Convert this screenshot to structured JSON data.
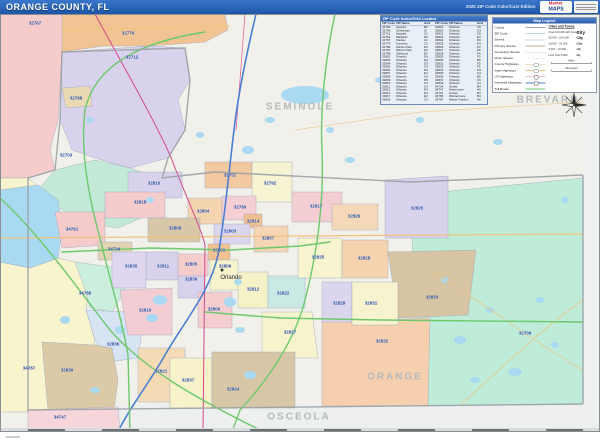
{
  "header": {
    "title": "ORANGE COUNTY, FL",
    "edition": "2020 ZIP Code Color/Cast Edition",
    "logo_line1": "Market",
    "logo_line2": "MAPS"
  },
  "map": {
    "city_label": "Orlando",
    "county_labels": [
      {
        "text": "SEMINOLE",
        "x": 300,
        "y": 107
      },
      {
        "text": "BREVARD",
        "x": 548,
        "y": 100
      },
      {
        "text": "ORANGE",
        "x": 395,
        "y": 377
      },
      {
        "text": "OSCEOLA",
        "x": 299,
        "y": 417
      }
    ],
    "zip_labels": [
      {
        "text": "32767",
        "x": 35,
        "y": 23
      },
      {
        "text": "32776",
        "x": 128,
        "y": 33
      },
      {
        "text": "32712",
        "x": 132,
        "y": 57
      },
      {
        "text": "32798",
        "x": 76,
        "y": 98
      },
      {
        "text": "32703",
        "x": 66,
        "y": 155
      },
      {
        "text": "32810",
        "x": 154,
        "y": 183
      },
      {
        "text": "32751",
        "x": 230,
        "y": 175
      },
      {
        "text": "32792",
        "x": 270,
        "y": 183
      },
      {
        "text": "32818",
        "x": 140,
        "y": 202
      },
      {
        "text": "32804",
        "x": 203,
        "y": 211
      },
      {
        "text": "32789",
        "x": 240,
        "y": 207
      },
      {
        "text": "32817",
        "x": 316,
        "y": 206
      },
      {
        "text": "32820",
        "x": 417,
        "y": 208
      },
      {
        "text": "34761",
        "x": 72,
        "y": 229
      },
      {
        "text": "32808",
        "x": 175,
        "y": 228
      },
      {
        "text": "32814",
        "x": 253,
        "y": 221
      },
      {
        "text": "32803",
        "x": 230,
        "y": 231
      },
      {
        "text": "32807",
        "x": 268,
        "y": 238
      },
      {
        "text": "34734",
        "x": 114,
        "y": 249
      },
      {
        "text": "32801",
        "x": 219,
        "y": 250
      },
      {
        "text": "32825",
        "x": 318,
        "y": 257
      },
      {
        "text": "32826",
        "x": 354,
        "y": 216
      },
      {
        "text": "32828",
        "x": 364,
        "y": 258
      },
      {
        "text": "32811",
        "x": 163,
        "y": 266
      },
      {
        "text": "32805",
        "x": 191,
        "y": 264
      },
      {
        "text": "32806",
        "x": 225,
        "y": 266
      },
      {
        "text": "32835",
        "x": 131,
        "y": 266
      },
      {
        "text": "32839",
        "x": 191,
        "y": 279
      },
      {
        "text": "32812",
        "x": 253,
        "y": 289
      },
      {
        "text": "32822",
        "x": 283,
        "y": 293
      },
      {
        "text": "34786",
        "x": 85,
        "y": 293
      },
      {
        "text": "32819",
        "x": 145,
        "y": 310
      },
      {
        "text": "32809",
        "x": 214,
        "y": 309
      },
      {
        "text": "32829",
        "x": 339,
        "y": 303
      },
      {
        "text": "32831",
        "x": 371,
        "y": 303
      },
      {
        "text": "32833",
        "x": 432,
        "y": 297
      },
      {
        "text": "32827",
        "x": 290,
        "y": 332
      },
      {
        "text": "32709",
        "x": 525,
        "y": 333
      },
      {
        "text": "32836",
        "x": 113,
        "y": 344
      },
      {
        "text": "32832",
        "x": 382,
        "y": 341
      },
      {
        "text": "32830",
        "x": 67,
        "y": 370
      },
      {
        "text": "32821",
        "x": 161,
        "y": 371
      },
      {
        "text": "32837",
        "x": 188,
        "y": 380
      },
      {
        "text": "32824",
        "x": 233,
        "y": 389
      },
      {
        "text": "34787",
        "x": 29,
        "y": 368
      },
      {
        "text": "34747",
        "x": 60,
        "y": 417
      }
    ]
  },
  "index_table": {
    "title": "ZIP Code Index/Grid Locator",
    "columns": [
      "ZIP Code",
      "ZIP Name",
      "Grid"
    ],
    "rows": [
      [
        "32703",
        "Apopka",
        "B3"
      ],
      [
        "32709",
        "Christmas",
        "I5"
      ],
      [
        "32712",
        "Apopka",
        "C1"
      ],
      [
        "32751",
        "Maitland",
        "D3"
      ],
      [
        "32767",
        "Paisley",
        "A1"
      ],
      [
        "32776",
        "Sorrento",
        "C1"
      ],
      [
        "32789",
        "Winter Park",
        "D3"
      ],
      [
        "32792",
        "Winter Park",
        "E3"
      ],
      [
        "32798",
        "Zellwood",
        "B2"
      ],
      [
        "32801",
        "Orlando",
        "D4"
      ],
      [
        "32803",
        "Orlando",
        "D4"
      ],
      [
        "32804",
        "Orlando",
        "D3"
      ],
      [
        "32805",
        "Orlando",
        "C4"
      ],
      [
        "32806",
        "Orlando",
        "D4"
      ],
      [
        "32807",
        "Orlando",
        "E4"
      ],
      [
        "32808",
        "Orlando",
        "C4"
      ],
      [
        "32809",
        "Orlando",
        "D5"
      ],
      [
        "32810",
        "Orlando",
        "C3"
      ],
      [
        "32811",
        "Orlando",
        "C4"
      ],
      [
        "32812",
        "Orlando",
        "E4"
      ],
      [
        "32814",
        "Orlando",
        "D3"
      ],
      [
        "32817",
        "Orlando",
        "E3"
      ],
      [
        "32818",
        "Orlando",
        "C3"
      ],
      [
        "32819",
        "Orlando",
        "C5"
      ],
      [
        "32820",
        "Orlando",
        "G3"
      ],
      [
        "32821",
        "Orlando",
        "C6"
      ],
      [
        "32822",
        "Orlando",
        "E4"
      ],
      [
        "32824",
        "Orlando",
        "D6"
      ],
      [
        "32825",
        "Orlando",
        "E4"
      ],
      [
        "32826",
        "Orlando",
        "F3"
      ],
      [
        "32827",
        "Orlando",
        "E5"
      ],
      [
        "32828",
        "Orlando",
        "F4"
      ],
      [
        "32829",
        "Orlando",
        "F5"
      ],
      [
        "32830",
        "Orlando",
        "B6"
      ],
      [
        "32831",
        "Orlando",
        "F5"
      ],
      [
        "32832",
        "Orlando",
        "F5"
      ],
      [
        "32833",
        "Orlando",
        "G5"
      ],
      [
        "32835",
        "Orlando",
        "C4"
      ],
      [
        "32836",
        "Orlando",
        "B5"
      ],
      [
        "32837",
        "Orlando",
        "C6"
      ],
      [
        "32839",
        "Orlando",
        "C4"
      ],
      [
        "34734",
        "Gotha",
        "B4"
      ],
      [
        "34747",
        "Kissimmee",
        "A6"
      ],
      [
        "34761",
        "Ocoee",
        "B4"
      ],
      [
        "34786",
        "Windermere",
        "B4"
      ],
      [
        "34787",
        "Winter Garden",
        "A6"
      ]
    ]
  },
  "legend": {
    "title": "Map Legend",
    "road_rows": [
      {
        "label": "County",
        "color": "#a9a9a9",
        "style": "plain"
      },
      {
        "label": "ZIP Code",
        "color": "#7bafd4",
        "style": "plain"
      },
      {
        "label": "Streets",
        "color": "#d9d9d9",
        "style": "plain"
      },
      {
        "label": "Primary Streets",
        "color": "#c3b696",
        "style": "plain"
      },
      {
        "label": "Secondary Streets",
        "color": "#cfcfc0",
        "style": "plain"
      },
      {
        "label": "Minor Streets",
        "color": "#e3e3e3",
        "style": "plain"
      },
      {
        "label": "County Highways",
        "color": "#e9e2c9",
        "style": "oval"
      },
      {
        "label": "State Highways",
        "color": "#f2c27d",
        "style": "oval"
      },
      {
        "label": "US Highways",
        "color": "#e27ba6",
        "style": "shield"
      },
      {
        "label": "Interstate Highways",
        "color": "#4a7fd4",
        "style": "shield"
      },
      {
        "label": "Toll Roads",
        "color": "#6cc96c",
        "style": "plain"
      }
    ],
    "cities": {
      "header": "Cities and Towns",
      "rows": [
        {
          "range": "Over 100,000 with Streets",
          "sample": "City",
          "size": 9
        },
        {
          "range": "25,000 - 100,000",
          "sample": "City",
          "size": 7
        },
        {
          "range": "10,000 - 25,000",
          "sample": "City",
          "size": 6
        },
        {
          "range": "5,000 - 10,000",
          "sample": "city",
          "size": 5
        },
        {
          "range": "Less than 5,000",
          "sample": "city",
          "size": 4.5
        }
      ]
    },
    "scales": [
      {
        "label": "Miles"
      },
      {
        "label": "Kilometers"
      }
    ]
  },
  "colors": {
    "header_bg": "#2b66bd",
    "water": "#a9daf1",
    "toll_road": "#6cc96c",
    "interstate": "#4a7fd4",
    "us_highway": "#d4488e",
    "state_highway": "#f2c27d",
    "zip_label": "#23479f",
    "county_label": "#b4babd"
  }
}
